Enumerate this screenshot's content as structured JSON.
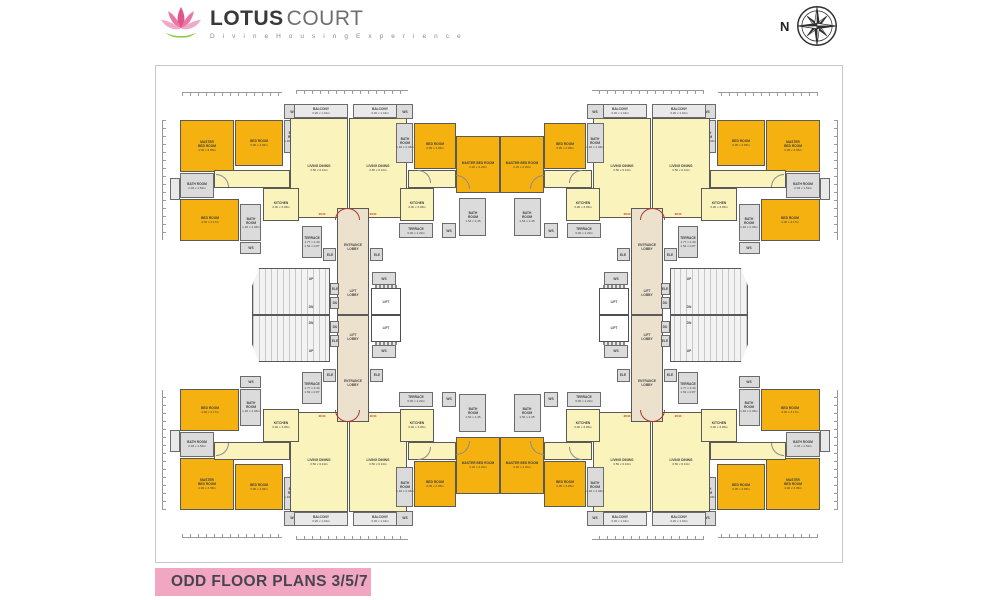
{
  "header": {
    "brand_bold": "LOTUS",
    "brand_light": "COURT",
    "tagline": "D i v i n e   H o u s i n g   E x p e r i e n c e",
    "compass_label": "N"
  },
  "footer": {
    "title": "ODD FLOOR PLANS 3/5/7"
  },
  "colors": {
    "room_orange": "#F5B110",
    "room_pale_yellow": "#FAF3BC",
    "lobby_beige": "#EBE1CC",
    "room_gray": "#DBDBDB",
    "wall": "#595959",
    "banner_pink": "#F1A6C2",
    "entry_marker_red": "#C0392B",
    "logo_pink": "#E0558C"
  },
  "plan": {
    "quadrants": [
      "top-left",
      "top-right",
      "bottom-left",
      "bottom-right"
    ],
    "rooms": [
      {
        "name": "dim-ticks-left",
        "type": "tickv",
        "x": 6,
        "y": 40,
        "w": 4,
        "h": 120
      },
      {
        "name": "dim-ticks-top",
        "type": "tickh",
        "x": 26,
        "y": 12,
        "w": 100,
        "h": 4
      },
      {
        "name": "dim-ticks-top-2",
        "type": "tickh",
        "x": 140,
        "y": 10,
        "w": 112,
        "h": 4
      },
      {
        "name": "window-bay",
        "type": "ltgray",
        "x": 14,
        "y": 98,
        "w": 10,
        "h": 22
      },
      {
        "name": "room-master-bed-room",
        "label": "MASTER\nBED ROOM",
        "dim": "4.06 x 3.35m",
        "type": "orange",
        "x": 24,
        "y": 40,
        "w": 54,
        "h": 52
      },
      {
        "name": "room-bed-room",
        "label": "BED ROOM",
        "dim": "3.05 x 3.05m",
        "type": "orange",
        "x": 79,
        "y": 40,
        "w": 48,
        "h": 46
      },
      {
        "name": "room-bath-room",
        "label": "BATH\nROOM",
        "dim": "1.46 x 2.46m",
        "type": "gray",
        "x": 128,
        "y": 40,
        "w": 18,
        "h": 33
      },
      {
        "name": "ws-box",
        "label": "WS",
        "type": "gray",
        "x": 128,
        "y": 24,
        "w": 18,
        "h": 15
      },
      {
        "name": "room-bath-room-2",
        "label": "BATH ROOM",
        "dim": "2.03 x 1.52m",
        "type": "gray",
        "x": 24,
        "y": 93,
        "w": 34,
        "h": 25
      },
      {
        "name": "room-bed-room-2",
        "label": "BED ROOM",
        "dim": "4.06 x 3.17m",
        "type": "orange",
        "x": 24,
        "y": 119,
        "w": 59,
        "h": 42
      },
      {
        "name": "room-bath-room-3",
        "label": "BATH\nROOM",
        "dim": "1.46 x 2.46m",
        "type": "gray",
        "x": 84,
        "y": 124,
        "w": 21,
        "h": 37
      },
      {
        "name": "ws-box-2",
        "label": "WS",
        "type": "gray",
        "x": 84,
        "y": 162,
        "w": 21,
        "h": 12
      },
      {
        "name": "corridor",
        "type": "pale",
        "x": 58,
        "y": 90,
        "w": 76,
        "h": 18
      },
      {
        "name": "room-balcony",
        "label": "BALCONY",
        "dim": "3.20 x 1.01m",
        "type": "ltgray",
        "x": 138,
        "y": 24,
        "w": 54,
        "h": 14
      },
      {
        "name": "room-living-dining",
        "label": "LIVING DINING",
        "dim": "3.50 x 6.10m",
        "type": "pale",
        "x": 134,
        "y": 38,
        "w": 58,
        "h": 100
      },
      {
        "name": "room-kitchen",
        "label": "KITCHEN",
        "dim": "3.00 x 3.05m",
        "type": "pale",
        "x": 107,
        "y": 108,
        "w": 36,
        "h": 33
      },
      {
        "name": "room-terrace",
        "label": "TERRACE",
        "dim": "1.77 x 4.39\n1.54 x 0.87",
        "type": "gray",
        "x": 146,
        "y": 146,
        "w": 20,
        "h": 32
      },
      {
        "name": "room-balcony-2",
        "label": "BALCONY",
        "dim": "3.20 x 1.01m",
        "type": "ltgray",
        "x": 197,
        "y": 24,
        "w": 54,
        "h": 14
      },
      {
        "name": "room-living-dining-2",
        "label": "LIVING DINING",
        "dim": "3.50 x 6.10m",
        "type": "pale",
        "x": 193,
        "y": 38,
        "w": 58,
        "h": 100
      },
      {
        "name": "room-bath-room-4",
        "label": "BATH\nROOM",
        "dim": "1.46 x 2.46m",
        "type": "gray",
        "x": 240,
        "y": 43,
        "w": 17,
        "h": 40
      },
      {
        "name": "ws-box-3",
        "label": "WS",
        "type": "gray",
        "x": 240,
        "y": 24,
        "w": 17,
        "h": 15
      },
      {
        "name": "room-bed-room-3",
        "label": "BED ROOM",
        "dim": "3.05 x 3.05m",
        "type": "orange",
        "x": 258,
        "y": 43,
        "w": 42,
        "h": 46
      },
      {
        "name": "corridor-2",
        "type": "pale",
        "x": 252,
        "y": 90,
        "w": 48,
        "h": 18
      },
      {
        "name": "room-kitchen-2",
        "label": "KITCHEN",
        "dim": "3.00 x 3.05m",
        "type": "pale",
        "x": 244,
        "y": 108,
        "w": 34,
        "h": 33
      },
      {
        "name": "room-terrace-2",
        "label": "TERRACE",
        "dim": "3.00 x 1.22m",
        "type": "gray",
        "x": 243,
        "y": 143,
        "w": 34,
        "h": 15
      },
      {
        "name": "ws-box-4",
        "label": "WS",
        "type": "gray",
        "x": 286,
        "y": 143,
        "w": 14,
        "h": 15
      },
      {
        "name": "room-master-bed-room-2",
        "label": "MASTER BED ROOM",
        "dim": "3.20 x 4.20m",
        "type": "orange",
        "x": 300,
        "y": 56,
        "w": 44,
        "h": 57
      },
      {
        "name": "room-bath-room-5",
        "label": "BATH\nROOM",
        "dim": "1.54 x 2.45",
        "type": "gray",
        "x": 303,
        "y": 118,
        "w": 27,
        "h": 38
      },
      {
        "name": "entrance-lobby",
        "type": "beige",
        "x": 181,
        "y": 128,
        "w": 32,
        "h": 107
      },
      {
        "name": "entrance-lobby-label",
        "label": "ENTRANCE\nLOBBY",
        "type": "plain",
        "x": 181,
        "y": 158,
        "w": 32,
        "h": 18
      },
      {
        "name": "lift-lobby-label",
        "label": "LIFT\nLOBBY",
        "type": "plain",
        "x": 181,
        "y": 204,
        "w": 32,
        "h": 18
      },
      {
        "name": "shaft-ele",
        "label": "ELE",
        "type": "gray",
        "x": 167,
        "y": 168,
        "w": 13,
        "h": 13
      },
      {
        "name": "shaft-ele-2",
        "label": "ELE",
        "type": "gray",
        "x": 214,
        "y": 168,
        "w": 13,
        "h": 13
      },
      {
        "name": "staircase",
        "type": "stairs",
        "x": 96,
        "y": 188,
        "w": 78,
        "h": 47
      },
      {
        "name": "stairs-up-label",
        "label": "UP",
        "type": "plain",
        "x": 144,
        "y": 194,
        "w": 22,
        "h": 10
      },
      {
        "name": "stairs-dn-label",
        "label": "DN",
        "type": "plain",
        "x": 144,
        "y": 222,
        "w": 22,
        "h": 10
      },
      {
        "name": "shaft-ele-3",
        "label": "ELE",
        "type": "gray",
        "x": 174,
        "y": 203,
        "w": 9,
        "h": 12
      },
      {
        "name": "shaft-du",
        "label": "DU",
        "type": "gray",
        "x": 174,
        "y": 217,
        "w": 9,
        "h": 12
      },
      {
        "name": "ws-box-5",
        "label": "WS",
        "type": "gray",
        "x": 216,
        "y": 192,
        "w": 24,
        "h": 13
      },
      {
        "name": "lift",
        "label": "LIFT",
        "type": "lift",
        "x": 215,
        "y": 208,
        "w": 30,
        "h": 27
      },
      {
        "name": "entry-door-arc",
        "type": "arc",
        "x": 179,
        "y": 128,
        "w": 25,
        "h": 12
      },
      {
        "name": "entry-marker",
        "label": "2044",
        "type": "red",
        "x": 155,
        "y": 130,
        "w": 22,
        "h": 8
      },
      {
        "name": "entry-marker-2",
        "label": "2044",
        "type": "red",
        "x": 206,
        "y": 130,
        "w": 22,
        "h": 8
      },
      {
        "name": "door-arc",
        "type": "arcg",
        "x": 60,
        "y": 94,
        "w": 13,
        "h": 13
      },
      {
        "name": "door-arc-2",
        "type": "arcg",
        "x": 262,
        "y": 90,
        "w": 13,
        "h": 13
      },
      {
        "name": "door-arc-3",
        "type": "arcg",
        "x": 300,
        "y": 95,
        "w": 14,
        "h": 14
      }
    ]
  }
}
